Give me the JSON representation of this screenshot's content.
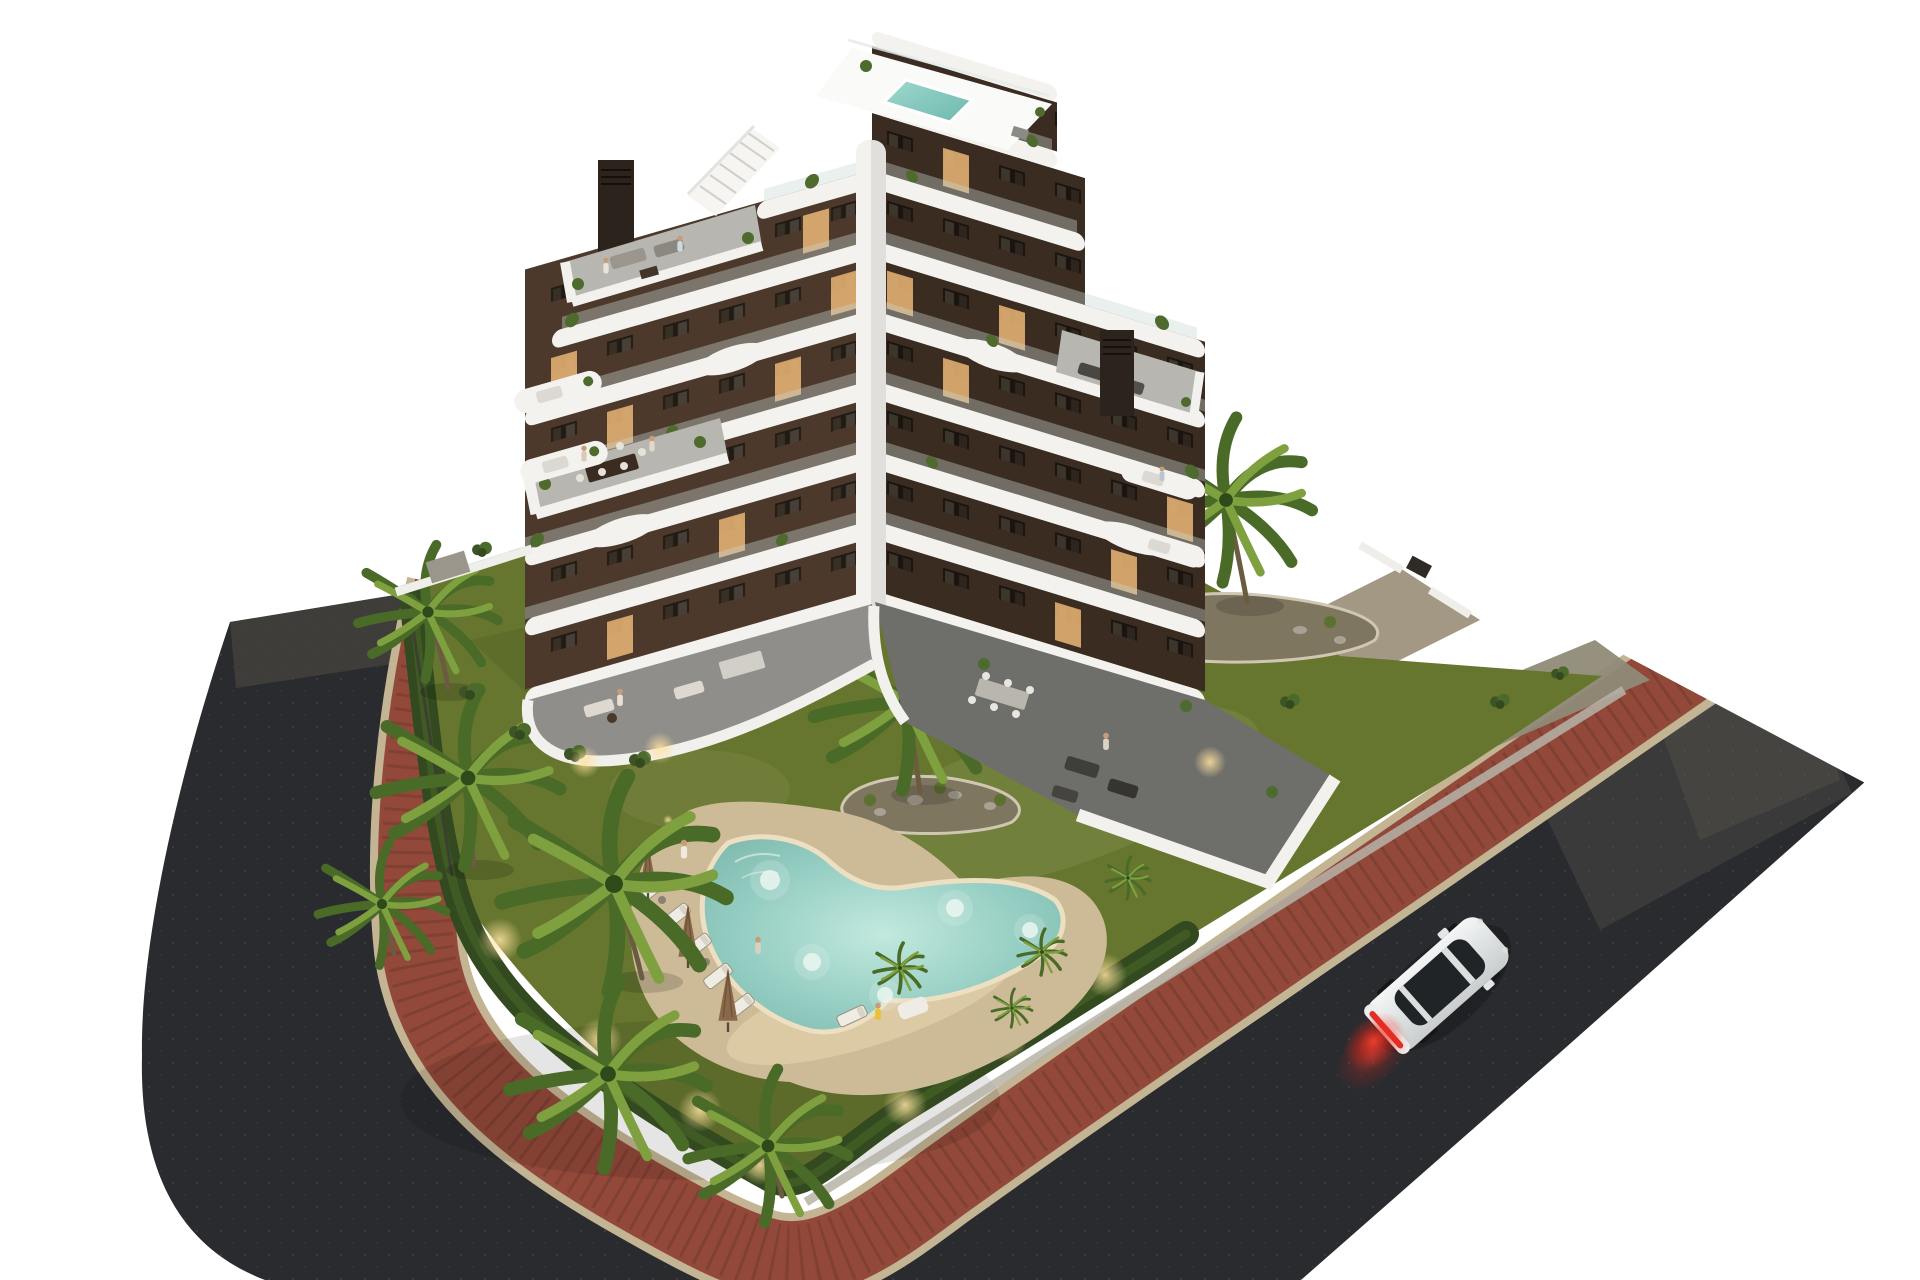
{
  "scene": {
    "type": "architectural-render",
    "description": "Aerial dusk 3D rendering of a modern apartment building with curved white balcony bands, landscaped garden with free-form pool, palm trees, wrap-around street with red brick sidewalk and a white car, isolated on a white background",
    "time_of_day": "dusk",
    "background": "#ffffff"
  },
  "palette": {
    "background": "#ffffff",
    "asphalt": "#292b2f",
    "asphalt_light": "#45423c",
    "sidewalk_brick": "#92493a",
    "sidewalk_curb": "#c3b493",
    "lawn": "#67762f",
    "lawn_light": "#7c8a47",
    "hedge": "#33491f",
    "palm_dark": "#4a6a28",
    "palm_light": "#7fa03f",
    "pool_deck": "#cdbb98",
    "pool_water": "#8fcac0",
    "pool_coping": "#ecdfc2",
    "facade_left": "#4c392b",
    "facade_right": "#3b2c21",
    "band_white": "#f3f2ee",
    "roof_white": "#fafaf8",
    "terrace_pavers": "#b8b6b0",
    "terrace_dark": "#6e6e6a",
    "window_dark": "#211b15",
    "window_lit": "#e2b072",
    "chimney": "#2c231c",
    "gravel": "#b7b3a8",
    "car_body": "#eceeee",
    "car_glass": "#202426",
    "taillight": "#e03026",
    "glow_warm": "#ffd98c"
  },
  "building": {
    "name": "modern-apartment-block",
    "floors_left_wing": 6,
    "floors_right_wing": 7,
    "penthouse_levels": 2,
    "balcony_style": "curved white wrap-around bands with glass railings",
    "rooftop_features": [
      "plunge pool",
      "roof terrace",
      "external stair",
      "2 ventilation chimneys",
      "planters"
    ],
    "lit_windows": true
  },
  "garden": {
    "pool": {
      "shape": "free-form boomerang",
      "lights_on": true
    },
    "sun_loungers": 6,
    "closed_umbrellas": 3,
    "palm_trees_large": 8,
    "palm_trees_small": 4,
    "planting_islands": 2,
    "hedge_perimeter": true,
    "path_lights": 7
  },
  "streets": {
    "surface": "asphalt",
    "sidewalk": "red brick with sand-colored curbs",
    "layout": "street wraps the plot from upper-left around the bottom corner to upper-right",
    "car": {
      "color": "white",
      "type": "coupe",
      "heading": "up-right",
      "taillights": "lit red"
    }
  },
  "people": [
    {
      "location": "rooftop terrace"
    },
    {
      "location": "rooftop terrace"
    },
    {
      "location": "mid-level terrace"
    },
    {
      "location": "mid-level terrace"
    },
    {
      "location": "upper balcony"
    },
    {
      "location": "ground terrace"
    },
    {
      "location": "pool deck standing"
    },
    {
      "location": "sun lounger"
    },
    {
      "location": "pool deck seated"
    },
    {
      "location": "walled terrace"
    }
  ]
}
